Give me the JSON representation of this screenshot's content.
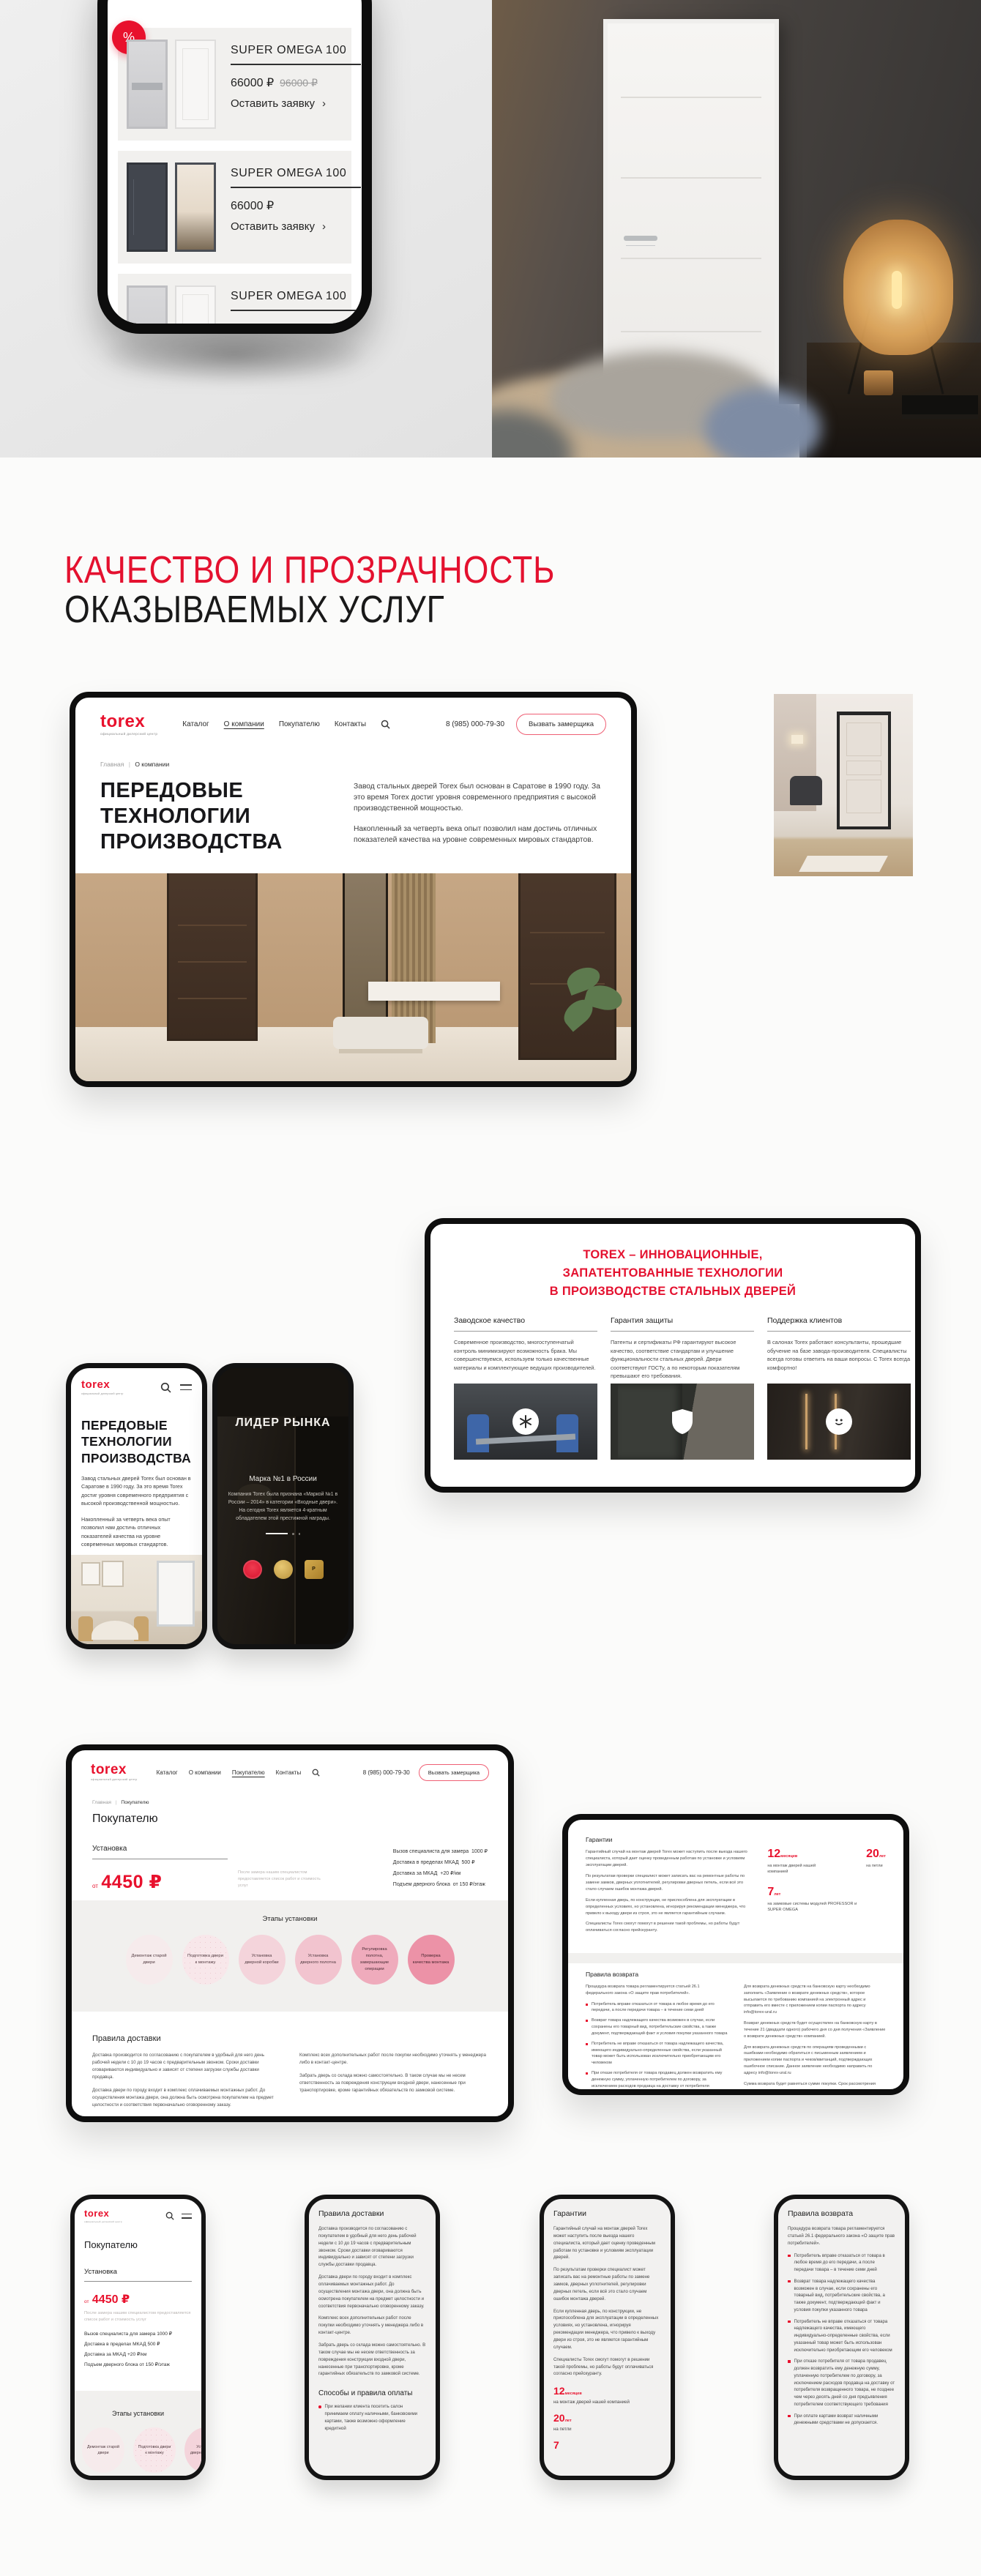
{
  "colors": {
    "accent": "#e8112d",
    "heading_red": "#e4112f",
    "steps_pink": [
      "#f6ebec",
      "#f8e7ea",
      "#f4d4db",
      "#f2c4cf",
      "#efabbc",
      "#ec92a7"
    ]
  },
  "brand": {
    "logo": "torex",
    "logo_sub": "официальный дилерский центр"
  },
  "nav": {
    "items": [
      "Каталог",
      "О компании",
      "Покупателю",
      "Контакты"
    ],
    "phone": "8 (985) 000-79-30",
    "cta": "Вызвать замерщика"
  },
  "catalog_phone": {
    "badge": "%",
    "products": [
      {
        "title": "SUPER OMEGA 100",
        "price": "66000 ₽",
        "old_price": "96000 ₽",
        "cta": "Оставить заявку",
        "chevron": "›"
      },
      {
        "title": "SUPER OMEGA 100",
        "price": "66000 ₽",
        "old_price": "",
        "cta": "Оставить заявку",
        "chevron": "›"
      },
      {
        "title": "SUPER OMEGA 100"
      }
    ]
  },
  "section_heading": {
    "line1": "КАЧЕСТВО И ПРОЗРАЧНОСТЬ",
    "line2": "ОКАЗЫВАЕМЫХ УСЛУГ"
  },
  "about_desktop": {
    "breadcrumb": {
      "home": "Главная",
      "sep": "|",
      "current": "О компании"
    },
    "title_lines": [
      "ПЕРЕДОВЫЕ",
      "ТЕХНОЛОГИИ",
      "ПРОИЗВОДСТВА"
    ],
    "p1": "Завод стальных дверей Torex был основан в Саратове в 1990 году. За это время Torex достиг уровня современного предприятия с высокой производственной мощностью.",
    "p2": "Накопленный за четверть века опыт позволил нам достичь отличных показателей качества на уровне современных мировых стандартов."
  },
  "innovations": {
    "title_lines": [
      "TOREX – ИННОВАЦИОННЫЕ,",
      "ЗАПАТЕНТОВАННЫЕ ТЕХНОЛОГИИ",
      "В ПРОИЗВОДСТВЕ СТАЛЬНЫХ ДВЕРЕЙ"
    ],
    "columns": [
      {
        "heading": "Заводское качество",
        "text": "Современное производство, многоступенчатый контроль минимизируют возможность брака. Мы совершенствуемся, используем только качественные материалы и комплектующие ведущих производителей.",
        "icon": "asterisk-icon"
      },
      {
        "heading": "Гарантия защиты",
        "text": "Патенты и сертификаты РФ гарантируют высокое качество, соответствие стандартам и улучшение функциональности стальных дверей. Двери соответствуют ГОСТу, а по некоторым показателям превышают его требования.",
        "icon": "shield-icon"
      },
      {
        "heading": "Поддержка клиентов",
        "text": "В салонах Torex работают консультанты, прошедшие обучение на базе завода-производителя. Специалисты всегда готовы ответить на ваши вопросы. С Torex всегда комфортно!",
        "icon": "smile-icon"
      },
      {
        "heading": "Ф",
        "text": "В салонах и более ком две се",
        "icon": ""
      }
    ]
  },
  "about_phone": {
    "title_lines": [
      "ПЕРЕДОВЫЕ",
      "ТЕХНОЛОГИИ",
      "ПРОИЗВОДСТВА"
    ],
    "p1": "Завод стальных дверей Torex был основан в Саратове в 1990 году. За это время Torex достиг уровня современного предприятия с высокой производственной мощностью.",
    "p2": "Накопленный за четверть века опыт позволил нам достичь отличных показателей качества на уровне современных мировых стандартов."
  },
  "leader_phone": {
    "title": "ЛИДЕР РЫНКА",
    "subtitle": "Марка №1 в России",
    "text": "Компания Torex была признана «Маркой №1 в России – 2014» в категории «Входные двери». На сегодня Torex является 4-кратным обладателем этой престижной награды."
  },
  "buyer_desktop": {
    "breadcrumb": {
      "home": "Главная",
      "sep": "|",
      "current": "Покупателю"
    },
    "title": "Покупателю",
    "install_heading": "Установка",
    "price_from": "от",
    "price": "4450 ₽",
    "note": "После замера нашим специалистом предоставляется список работ и стоимость услуг",
    "fees": [
      {
        "label": "Вызов специалиста для замера",
        "value": "1000 ₽"
      },
      {
        "label": "Доставка в пределах МКАД",
        "value": "500 ₽"
      },
      {
        "label": "Доставка за МКАД",
        "value": "+20 ₽/км"
      },
      {
        "label": "Подъем дверного блока",
        "value": "от 150 ₽/этаж"
      }
    ],
    "steps_title": "Этапы установки",
    "steps": [
      "Демонтаж старой двери",
      "Подготовка двери к монтажу",
      "Установка дверной коробки",
      "Установка дверного полотна",
      "Регулировка полотна, завершающие операции",
      "Проверка качества монтажа"
    ],
    "delivery_heading": "Правила доставки",
    "delivery_left": [
      "Доставка производится по согласованию с покупателем в удобный для него день рабочей недели с 10 до 19 часов с предварительным звонком. Сроки доставки оговариваются индивидуально и зависят от степени загрузки службы доставки продавца.",
      "Доставка двери по городу входит в комплекс оплачиваемых монтажных работ. До осуществления монтажа двери, она должна быть осмотрена покупателем на предмет целостности и соответствия первоначально оговоренному заказу."
    ],
    "delivery_right": [
      "Комплекс всех дополнительных работ после покупки необходимо уточнять у менеджера либо в контакт-центре.",
      "Забрать дверь со склада можно самостоятельно. В таком случае мы не несем ответственность за повреждения конструкции входной двери, нанесенные при транспортировке, кроме гарантийных обязательств по замковой системе."
    ]
  },
  "warranty_desktop": {
    "heading": "Гарантии",
    "paragraphs": [
      "Гарантийный случай на монтаж дверей Torex может наступить после выезда нашего специалиста, который дает оценку проведенным работам по установке и условиям эксплуатации дверей.",
      "По результатам проверки специалист может записать вас на ремонтные работы по замене замков, дверных уплотнителей, регулировки дверных петель, если всё это стало случаем ошибок монтажа дверей.",
      "Если купленная дверь, по конструкции, не приспособлена для эксплуатации в определенных условиях, но установлена, игнорируя рекомендации менеджера, что привело к выходу двери из строя, это не является гарантийным случаем.",
      "Специалисты Torex смогут помогут в решении такой проблемы, но работы будут оплачиваться согласно прейскуранту."
    ],
    "stats": [
      {
        "value": "12",
        "unit": "месяцев",
        "caption": "на монтаж дверей нашей компанией"
      },
      {
        "value": "20",
        "unit": "лет",
        "caption": "на петли"
      },
      {
        "value": "7",
        "unit": "лет",
        "caption": "на замковые системы модулей PROFESSOR и SUPER OMEGA"
      }
    ],
    "returns_heading": "Правила возврата",
    "returns_intro": "Процедура возврата товара регламентируется статьей 26.1 федерального закона «О защите прав потребителей».",
    "returns_bullets": [
      "Потребитель вправе отказаться от товара в любое время до его передачи, а после передачи товара – в течение семи дней",
      "Возврат товара надлежащего качества возможен в случае, если сохранены его товарный вид, потребительские свойства, а также документ, подтверждающий факт и условия покупки указанного товара",
      "Потребитель не вправе отказаться от товара надлежащего качества, имеющего индивидуально-определенные свойства, если указанный товар может быть использован исключительно приобретающим его человеком",
      "При отказе потребителя от товара продавец должен возвратить ему денежную сумму, уплаченную потребителем по договору, за исключением расходов продавца на доставку от потребителя возвращенного товара, не позднее чем через десять дней со дня предъявления потребителем соответствующего требования",
      "При оплате картами возврат наличными денежными средствами не допускается. Порядок возврата регулируется правилами международных платежных систем."
    ],
    "returns_right": [
      "Для возврата денежных средств на банковскую карту необходимо заполнить «Заявление о возврате денежных средств», которое высылается по требованию компанией на электронный адрес и отправить его вместе с приложением копии паспорта по адресу info@torex-ural.ru",
      "Возврат денежных средств будет осуществлен на банковскую карту в течение 21 (двадцати одного) рабочего дня со дня получения «Заявление о возврате денежных средств» компанией.",
      "Для возврата денежных средств по операциям проведенными с ошибками необходимо обратиться с письменным заявлением и приложением копии паспорта и чеков/квитанций, подтверждающих ошибочное списание. Данное заявление необходимо направить по адресу info@torex-ural.ru",
      "Сумма возврата будет равняться сумме покупки. Срок рассмотрения заявления и возврата денежных средств начинает исчисляться с момента получения Компанией Заявления и рассчитывается в рабочих днях без учета праздников/выходных дней."
    ]
  },
  "phone_buyer": {
    "title": "Покупателю",
    "install_heading": "Установка",
    "price_from": "от",
    "price": "4450 ₽",
    "note": "После замера нашим специалистом предоставляется список работ и стоимость услуг",
    "fees": [
      {
        "label": "Вызов специалиста для замера",
        "value": "1000 ₽"
      },
      {
        "label": "Доставка в пределах МКАД",
        "value": "500 ₽"
      },
      {
        "label": "Доставка за МКАД",
        "value": "+20 ₽/км"
      },
      {
        "label": "Подъем дверного блока",
        "value": "от 150 ₽/этаж"
      }
    ],
    "steps_title": "Этапы установки",
    "steps": [
      "Демонтаж старой двери",
      "Подготовка двери к монтажу",
      "Установка дверной коробки"
    ]
  },
  "phone_delivery": {
    "title": "Правила доставки",
    "paragraphs": [
      "Доставка производится по согласованию с покупателем в удобный для него день рабочей недели с 10 до 19 часов с предварительным звонком. Сроки доставки оговариваются индивидуально и зависят от степени загрузки службы доставки продавца.",
      "Доставка двери по городу входит в комплекс оплачиваемых монтажных работ. До осуществления монтажа двери, она должна быть осмотрена покупателем на предмет целостности и соответствия первоначально оговоренному заказу.",
      "Комплекс всех дополнительных работ после покупки необходимо уточнять у менеджера либо в контакт-центре.",
      "Забрать дверь со склада можно самостоятельно. В таком случае мы не несем ответственность за повреждения конструкции входной двери, нанесенные при транспортировке, кроме гарантийных обязательств по замковой системе."
    ],
    "payment_heading": "Способы и правила оплаты",
    "payment_bullet": "При желании клиента посетить салон принимаем оплату наличными, банковскими картами, также возможно оформление кредитной"
  },
  "phone_warranty": {
    "title": "Гарантии",
    "paragraphs": [
      "Гарантийный случай на монтаж дверей Torex может наступить после выезда нашего специалиста, который дает оценку проведенным работам по установке и условиям эксплуатации дверей.",
      "По результатам проверки специалист может записать вас на ремонтные работы по замене замков, дверных уплотнителей, регулировки дверных петель, если всё это стало случаем ошибок монтажа дверей.",
      "Если купленная дверь, по конструкции, не приспособлена для эксплуатации в определенных условиях, но установлена, игнорируя рекомендации менеджера, что привело к выходу двери из строя, это не является гарантийным случаем.",
      "Специалисты Torex смогут помогут в решении такой проблемы, но работы будут оплачиваться согласно прейскуранту."
    ],
    "stats": [
      {
        "value": "12",
        "unit": "месяцев",
        "caption": "на монтаж дверей нашей компанией"
      },
      {
        "value": "20",
        "unit": "лет",
        "caption": "на петли"
      },
      {
        "value": "7",
        "unit": "",
        "caption": ""
      }
    ]
  },
  "phone_returns": {
    "title": "Правила возврата",
    "intro": "Процедура возврата товара регламентируется статьей 26.1 федерального закона «О защите прав потребителей».",
    "bullets": [
      "Потребитель вправе отказаться от товара в любое время до его передачи, а после передачи товара – в течение семи дней",
      "Возврат товара надлежащего качества возможен в случае, если сохранены его товарный вид, потребительские свойства, а также документ, подтверждающий факт и условия покупки указанного товара",
      "Потребитель не вправе отказаться от товара надлежащего качества, имеющего индивидуально-определенные свойства, если указанный товар может быть использован исключительно приобретающим его человеком",
      "При отказе потребителя от товара продавец должен возвратить ему денежную сумму, уплаченную потребителем по договору, за исключением расходов продавца на доставку от потребителя возвращенного товара, не позднее чем через десять дней со дня предъявления потребителем соответствующего требования",
      "При оплате картами возврат наличными денежными средствами не допускается."
    ]
  }
}
